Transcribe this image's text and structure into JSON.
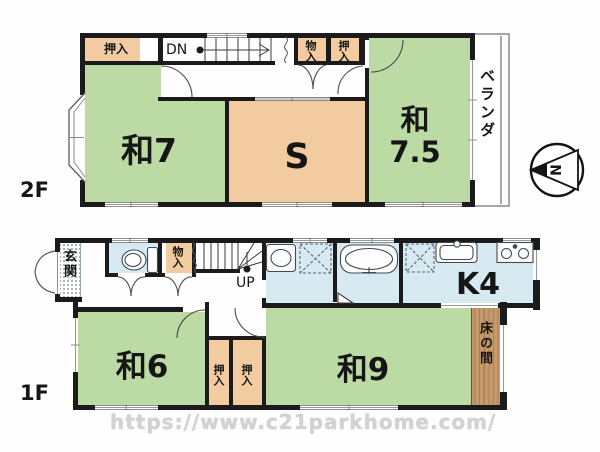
{
  "plan": {
    "floor2": {
      "floor_label": "2F",
      "rooms": {
        "washitsu7": "和7",
        "service": "S",
        "washitsu75_l1": "和",
        "washitsu75_l2": "7.5",
        "veranda": "ベランダ",
        "oshiire_left": "押入",
        "monoire": "物入",
        "oshiire_right": "押入",
        "stairs": "DN"
      }
    },
    "floor1": {
      "floor_label": "1F",
      "rooms": {
        "genkan": "玄関",
        "monoire": "物入",
        "stairs": "UP",
        "kitchen": "K4",
        "washitsu6": "和6",
        "oshiire_1": "押入",
        "oshiire_2": "押入",
        "washitsu9": "和9",
        "tokonoma": "床の間"
      }
    },
    "compass_north": "N",
    "watermark": "https://www.c21parkhome.com/",
    "colors": {
      "tatami_green": "#bcdaa3",
      "closet_peach": "#f2cba1",
      "wet_area_blue": "#d7eaf2",
      "tokonoma_wood": "#c59b6d",
      "wall": "#1b1b1b"
    }
  }
}
